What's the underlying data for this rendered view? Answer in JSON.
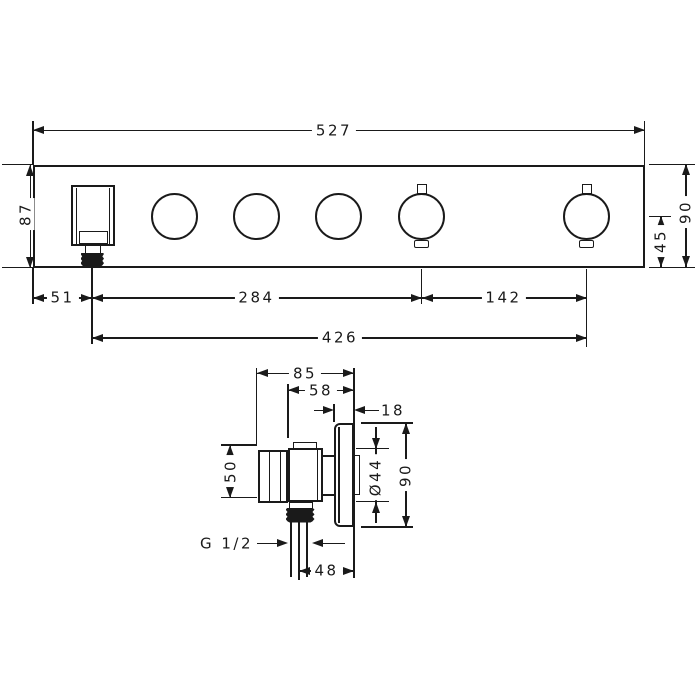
{
  "drawing_type": "technical dimension drawing, wall-mounted shower thermostat module (front view and side view), units mm",
  "top_view": {
    "width": "527",
    "height_left": "87",
    "height_right": "90",
    "knob_center_to_bottom": "45",
    "edge_to_outlet": "51",
    "outlet_to_knob4": "284",
    "knob4_to_knob5": "142",
    "outlet_to_knob5": "426"
  },
  "side_view": {
    "total_depth": "85",
    "body_depth": "58",
    "plate_thickness": "18",
    "body_height": "50",
    "hole_diameter": "Ø44",
    "plate_height": "90",
    "thread": "G 1/2",
    "outlet_to_wall": "48"
  },
  "colors": {
    "line": "#1a1a1a",
    "background": "#ffffff"
  }
}
